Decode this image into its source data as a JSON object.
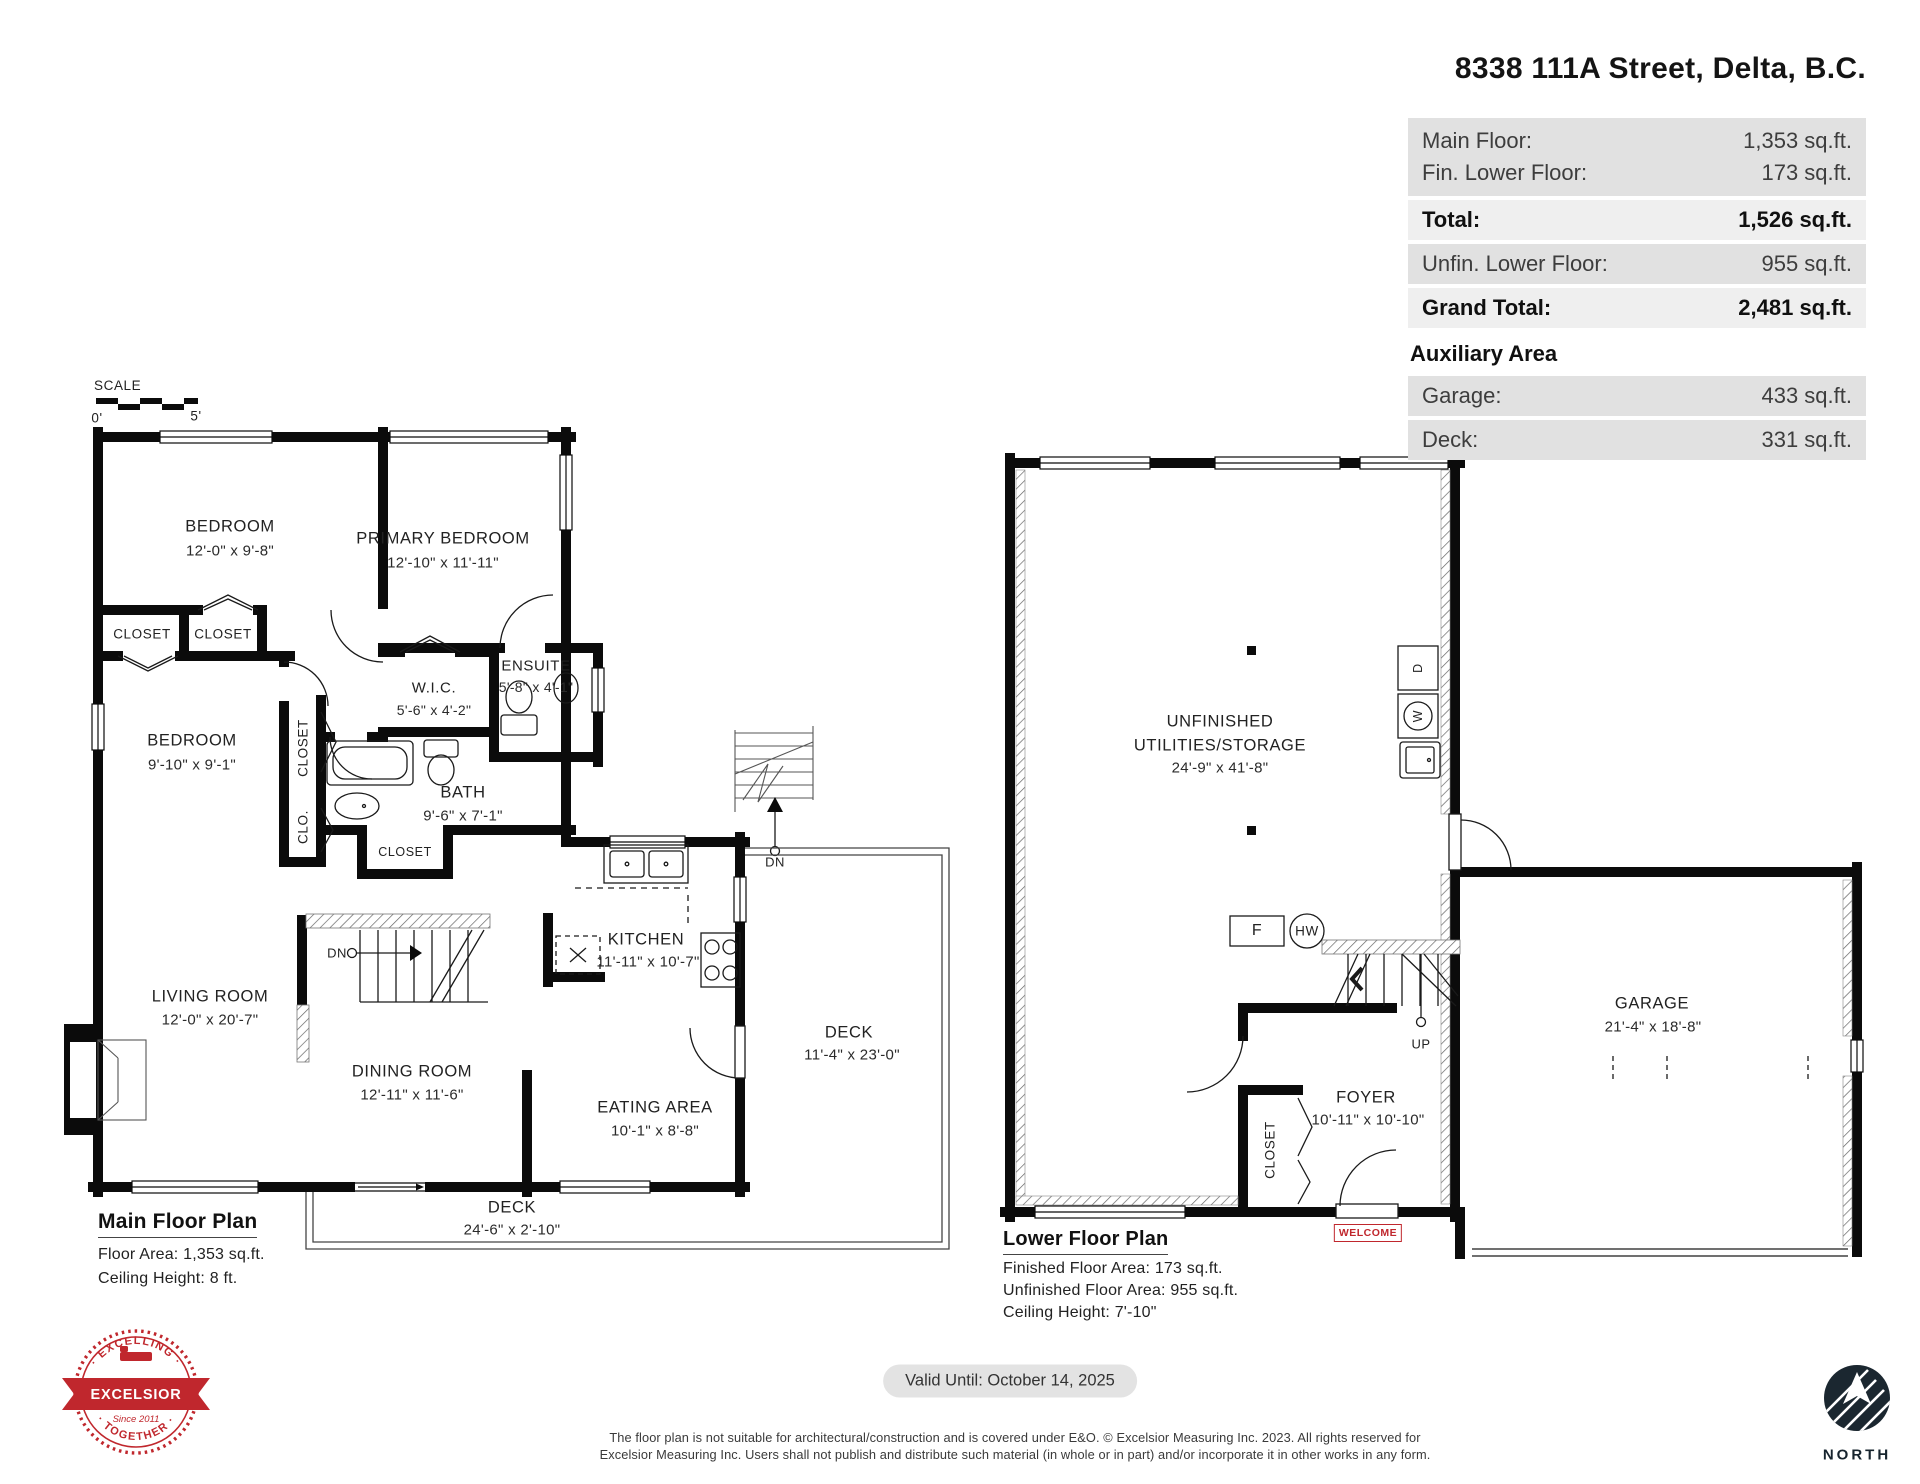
{
  "header": {
    "address": "8338 111A Street, Delta, B.C.",
    "rows": [
      {
        "label": "Main Floor:",
        "value": "1,353 sq.ft."
      },
      {
        "label": "Fin. Lower Floor:",
        "value": "173 sq.ft."
      },
      {
        "label": "Total:",
        "value": "1,526 sq.ft."
      },
      {
        "label": "Unfin. Lower Floor:",
        "value": "955 sq.ft."
      },
      {
        "label": "Grand Total:",
        "value": "2,481 sq.ft."
      },
      {
        "label": "Garage:",
        "value": "433 sq.ft."
      },
      {
        "label": "Deck:",
        "value": "331 sq.ft."
      }
    ],
    "auxiliary_title": "Auxiliary Area"
  },
  "scale": {
    "label": "SCALE",
    "zero": "0'",
    "five": "5'"
  },
  "main_floor": {
    "title": "Main Floor Plan",
    "floor_area": "Floor Area: 1,353 sq.ft.",
    "ceiling_height": "Ceiling Height: 8 ft.",
    "dn_label": "DN",
    "rooms": {
      "bedroom1": {
        "name": "BEDROOM",
        "dims": "12'-0\" x 9'-8\""
      },
      "primary": {
        "name": "PRIMARY BEDROOM",
        "dims": "12'-10\" x 11'-11\""
      },
      "closet_a": {
        "name": "CLOSET"
      },
      "closet_b": {
        "name": "CLOSET"
      },
      "bedroom2": {
        "name": "BEDROOM",
        "dims": "9'-10\" x 9'-1\""
      },
      "closet_side": {
        "name": "CLOSET"
      },
      "clo": {
        "name": "CLO."
      },
      "wic": {
        "name": "W.I.C.",
        "dims": "5'-6\" x 4'-2\""
      },
      "ensuite": {
        "name": "ENSUITE",
        "dims": "5'-8\" x 4'-1\""
      },
      "bath": {
        "name": "BATH",
        "dims": "9'-6\" x 7'-1\""
      },
      "closet_bath": {
        "name": "CLOSET"
      },
      "kitchen": {
        "name": "KITCHEN",
        "dims": "11'-11\" x 10'-7\""
      },
      "living": {
        "name": "LIVING ROOM",
        "dims": "12'-0\" x 20'-7\""
      },
      "dining": {
        "name": "DINING ROOM",
        "dims": "12'-11\" x 11'-6\""
      },
      "eating": {
        "name": "EATING AREA",
        "dims": "10'-1\" x 8'-8\""
      },
      "deck_bottom": {
        "name": "DECK",
        "dims": "24'-6\" x 2'-10\""
      },
      "deck_right": {
        "name": "DECK",
        "dims": "11'-4\" x 23'-0\""
      }
    }
  },
  "lower_floor": {
    "title": "Lower Floor Plan",
    "finished_area": "Finished Floor Area: 173 sq.ft.",
    "unfinished_area": "Unfinished Floor Area: 955 sq.ft.",
    "ceiling_height": "Ceiling Height: 7'-10\"",
    "rooms": {
      "utilities": {
        "line1": "UNFINISHED",
        "line2": "UTILITIES/STORAGE",
        "dims": "24'-9\" x 41'-8\""
      },
      "foyer": {
        "name": "FOYER",
        "dims": "10'-11\" x 10'-10\""
      },
      "garage": {
        "name": "GARAGE",
        "dims": "21'-4\" x 18'-8\""
      },
      "closet": {
        "name": "CLOSET"
      }
    },
    "labels": {
      "up": "UP",
      "furnace": "F",
      "hot_water": "HW",
      "dryer": "D",
      "washer": "W",
      "welcome": "WELCOME"
    }
  },
  "footer": {
    "valid_until": "Valid Until: October 14, 2025",
    "disclaimer_line1": "The floor plan is not suitable for architectural/construction and is covered under E&O. © Excelsior Measuring Inc. 2023. All rights reserved for",
    "disclaimer_line2": "Excelsior Measuring Inc. Users shall not publish and distribute such material (in whole or in part) and/or incorporate it in other works in any form.",
    "north_label": "NORTH",
    "stamp": {
      "arc_top": "· EXCELLING ·",
      "name": "EXCELSIOR",
      "arc_bottom": "· TOGETHER ·",
      "since": "Since 2011"
    }
  }
}
